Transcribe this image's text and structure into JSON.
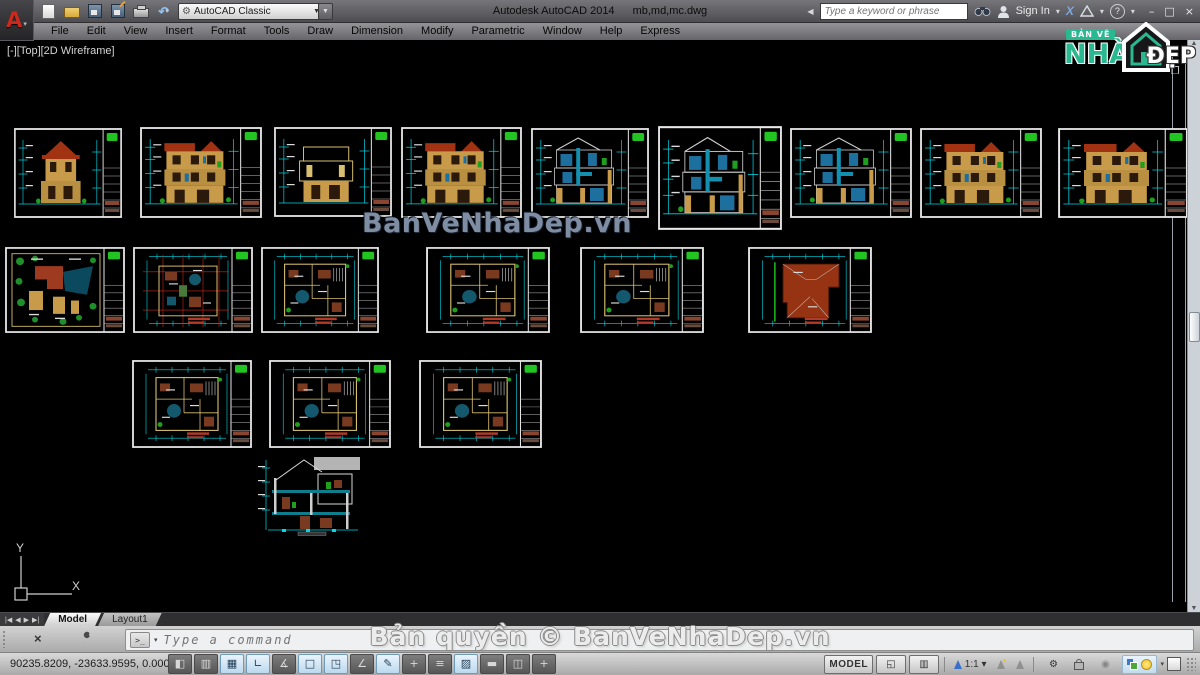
{
  "title_bar": {
    "app_title": "Autodesk AutoCAD 2014",
    "doc_title": "mb,md,mc.dwg",
    "workspace": "AutoCAD Classic",
    "search_placeholder": "Type a keyword or phrase",
    "sign_in": "Sign In"
  },
  "menu_bar": {
    "items": [
      "File",
      "Edit",
      "View",
      "Insert",
      "Format",
      "Tools",
      "Draw",
      "Dimension",
      "Modify",
      "Parametric",
      "Window",
      "Help",
      "Express"
    ]
  },
  "viewport_label": "[-][Top][2D Wireframe]",
  "watermark": "BanVeNhaDep.vn",
  "copyright": "Bản quyền © BanVeNhaDep.vn",
  "logo": {
    "top": "BẢN VẼ",
    "main": "NHÀ",
    "suffix": "ĐẸP"
  },
  "tabs": {
    "model": "Model",
    "layout1": "Layout1"
  },
  "command_line": {
    "placeholder": "Type a command"
  },
  "ucs": {
    "x_label": "X",
    "y_label": "Y"
  },
  "status_bar": {
    "coordinates": "90235.8209, -23633.9595, 0.0000",
    "model_button": "MODEL",
    "annotation_scale": "1:1",
    "toggles": [
      {
        "name": "infer-constraints",
        "pressed": false
      },
      {
        "name": "snap",
        "pressed": false
      },
      {
        "name": "grid",
        "pressed": true
      },
      {
        "name": "ortho",
        "pressed": true
      },
      {
        "name": "polar",
        "pressed": false
      },
      {
        "name": "osnap",
        "pressed": true
      },
      {
        "name": "3d-osnap",
        "pressed": true
      },
      {
        "name": "otrack",
        "pressed": false
      },
      {
        "name": "ducs",
        "pressed": true
      },
      {
        "name": "dynamic-input",
        "pressed": false
      },
      {
        "name": "lineweight",
        "pressed": false
      },
      {
        "name": "transparency",
        "pressed": true
      },
      {
        "name": "quick-properties",
        "pressed": false
      },
      {
        "name": "selection-cycling",
        "pressed": false
      },
      {
        "name": "annotation-monitor",
        "pressed": false
      }
    ]
  },
  "canvas": {
    "colors": {
      "dim_cyan": "#00d9e8",
      "wall_tan": "#c89b4a",
      "roof_red": "#a23312",
      "plant_green": "#1f9e1f",
      "sheet_border": "#e8e8e8",
      "accent_green": "#21c421",
      "teal": "#14586e",
      "grid_red": "#cc2a1a"
    },
    "sheets": [
      {
        "type": "elevation",
        "x": 14,
        "y": 128,
        "w": 108,
        "h": 90
      },
      {
        "type": "elevationB",
        "x": 140,
        "y": 127,
        "w": 122,
        "h": 91
      },
      {
        "type": "facade",
        "x": 274,
        "y": 127,
        "w": 118,
        "h": 90
      },
      {
        "type": "elevationB",
        "x": 401,
        "y": 127,
        "w": 121,
        "h": 91
      },
      {
        "type": "sectionBlue",
        "x": 531,
        "y": 128,
        "w": 118,
        "h": 90
      },
      {
        "type": "sectionBlue",
        "x": 658,
        "y": 126,
        "w": 124,
        "h": 104
      },
      {
        "type": "sectionBlue",
        "x": 790,
        "y": 128,
        "w": 122,
        "h": 90
      },
      {
        "type": "elevationB",
        "x": 920,
        "y": 128,
        "w": 122,
        "h": 90
      },
      {
        "type": "elevationB",
        "x": 1058,
        "y": 128,
        "w": 130,
        "h": 90
      },
      {
        "type": "siteplan",
        "x": 5,
        "y": 247,
        "w": 120,
        "h": 86
      },
      {
        "type": "planRed",
        "x": 133,
        "y": 247,
        "w": 120,
        "h": 86
      },
      {
        "type": "plan",
        "x": 261,
        "y": 247,
        "w": 118,
        "h": 86
      },
      {
        "type": "plan",
        "x": 426,
        "y": 247,
        "w": 124,
        "h": 86
      },
      {
        "type": "plan",
        "x": 580,
        "y": 247,
        "w": 124,
        "h": 86
      },
      {
        "type": "roofplan",
        "x": 748,
        "y": 247,
        "w": 124,
        "h": 86
      },
      {
        "type": "plan",
        "x": 132,
        "y": 360,
        "w": 120,
        "h": 88
      },
      {
        "type": "plan",
        "x": 269,
        "y": 360,
        "w": 122,
        "h": 88
      },
      {
        "type": "plan",
        "x": 419,
        "y": 360,
        "w": 123,
        "h": 88
      },
      {
        "type": "sectionOpen",
        "x": 258,
        "y": 452,
        "w": 127,
        "h": 84
      }
    ]
  }
}
